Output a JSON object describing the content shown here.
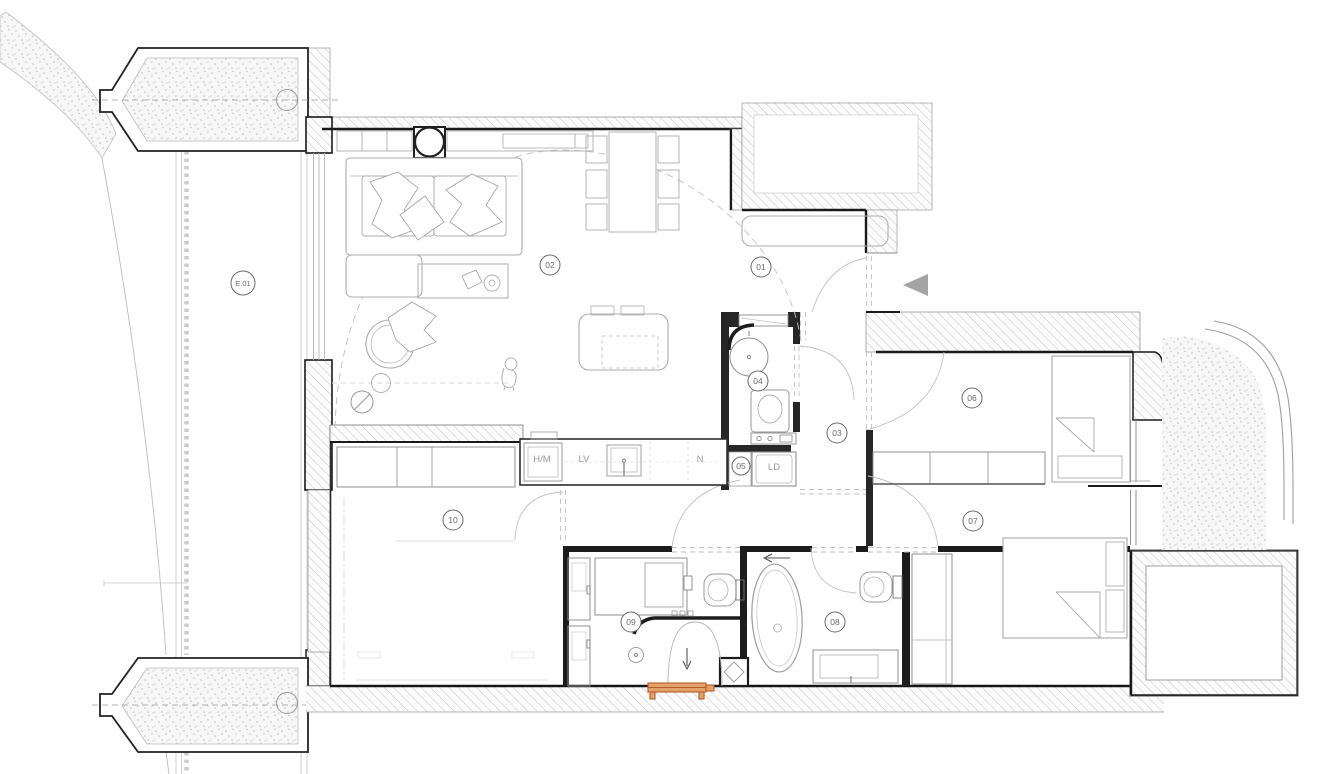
{
  "drawing": {
    "kind": "architectural apartment floor plan",
    "room_tags": {
      "e01": "E.01",
      "t01": "01",
      "t02": "02",
      "t03": "03",
      "t04": "04",
      "t05": "05",
      "t06": "06",
      "t07": "07",
      "t08": "08",
      "t09": "09",
      "t10": "10"
    },
    "fixture_tags": {
      "hm": "H/M",
      "lv": "LV",
      "n": "N",
      "ld": "LD"
    },
    "colors": {
      "paper": "#ffffff",
      "wall_dark": "#1c1c1c",
      "partition_dark": "#262626",
      "hatch_line": "#c4c4c4",
      "stipple_dot": "#bdbdbd",
      "furniture_line": "#adadad",
      "label_line": "#6a6a6a",
      "arrow_gray": "#a3a3a3",
      "bench_orange_stroke": "#b35f2a",
      "bench_orange_fill": "#e2a06b"
    }
  }
}
